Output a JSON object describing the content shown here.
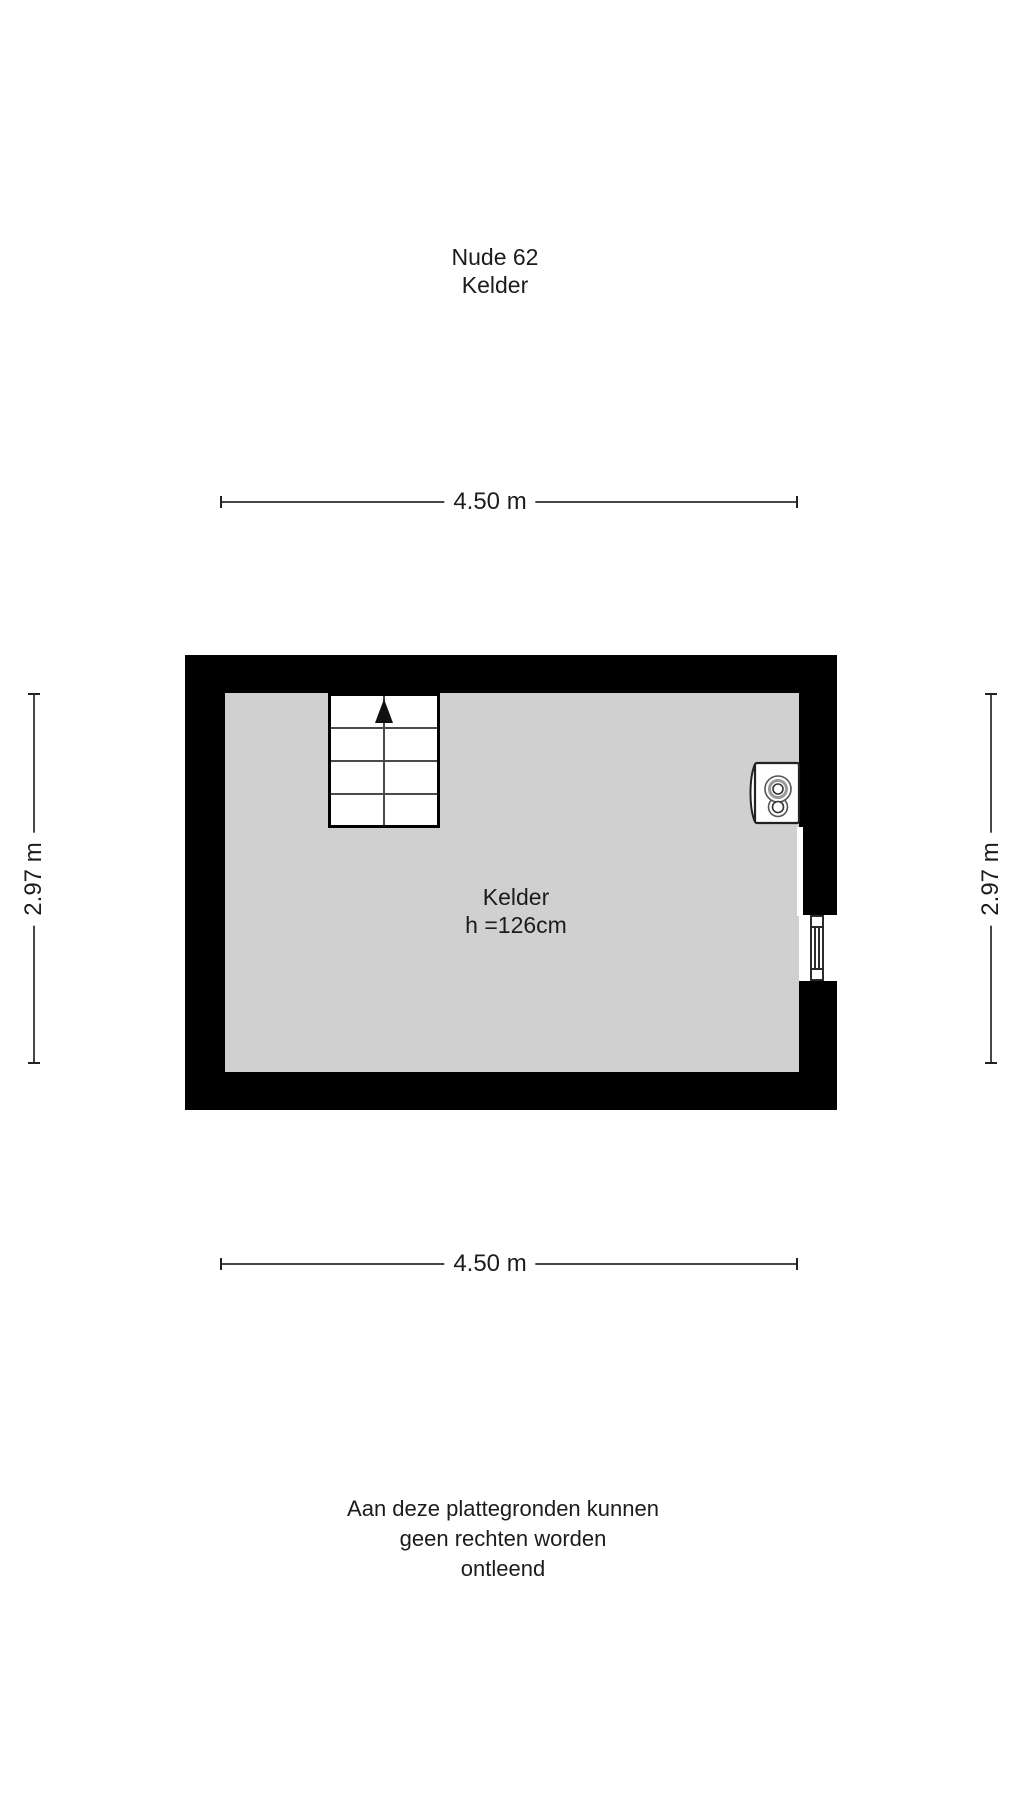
{
  "page": {
    "background": "#ffffff"
  },
  "header": {
    "title": "Nude 62",
    "subtitle": "Kelder"
  },
  "dimensions": {
    "top": "4.50 m",
    "bottom": "4.50 m",
    "left": "2.97 m",
    "right": "2.97 m"
  },
  "room": {
    "name": "Kelder",
    "ceiling_height": "h =126cm"
  },
  "fixtures": {
    "staircase": "staircase-with-up-arrow",
    "boiler": "wall-mounted-boiler",
    "window": "window-in-right-wall"
  },
  "disclaimer": {
    "line1": "Aan deze plattegronden kunnen",
    "line2": "geen rechten worden",
    "line3": "ontleend"
  },
  "colors": {
    "wall": "#000000",
    "floor": "#d0d0d0",
    "dimension_line": "#474747",
    "text": "#1c1c1c"
  }
}
